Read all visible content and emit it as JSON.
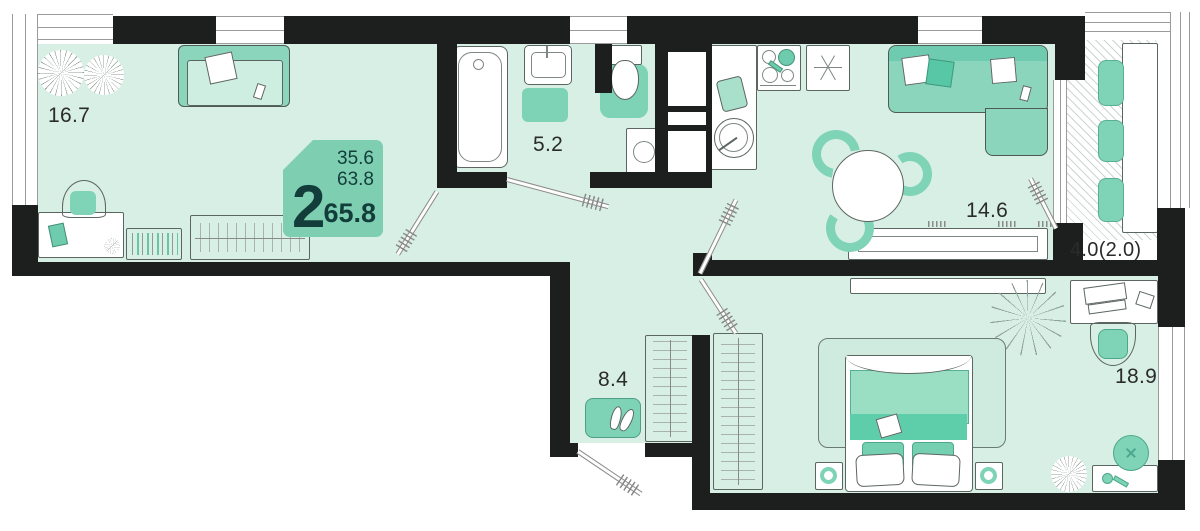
{
  "unit_badge": {
    "rooms_count": "2",
    "area_living": "35.6",
    "area_base": "63.8",
    "area_total": "65.8"
  },
  "rooms": [
    {
      "id": "living-room",
      "area": "16.7"
    },
    {
      "id": "bathroom",
      "area": "5.2"
    },
    {
      "id": "kitchen-living",
      "area": "14.6"
    },
    {
      "id": "balcony",
      "area": "4.0(2.0)"
    },
    {
      "id": "hallway",
      "area": "8.4"
    },
    {
      "id": "bedroom",
      "area": "18.9"
    }
  ],
  "colors": {
    "room_fill": "#d7efe4",
    "wall": "#1d1f1e",
    "furniture_teal": "#7fd3b7",
    "badge_bg": "#7ecfb1",
    "badge_text": "#133d3b",
    "line_gray": "#8a8a8a"
  }
}
